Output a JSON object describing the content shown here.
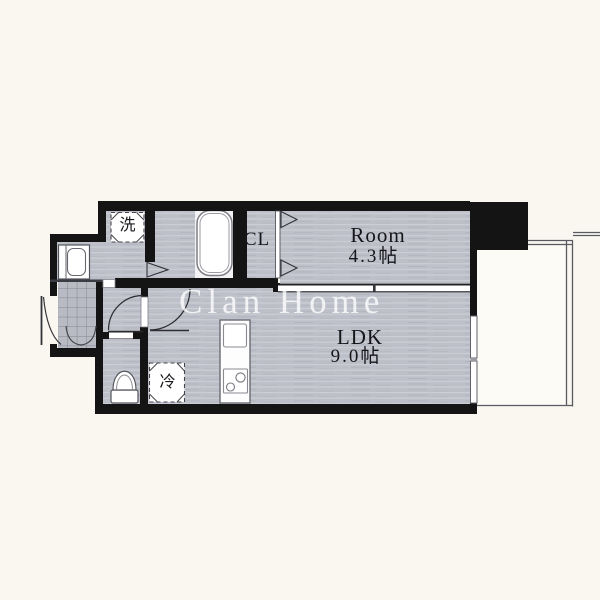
{
  "watermark": {
    "text": "Clan Home"
  },
  "rooms": {
    "bedroom": {
      "name": "Room",
      "size": "4.3帖"
    },
    "ldk": {
      "name": "LDK",
      "size": "9.0帖"
    },
    "closet": {
      "label": "CL"
    },
    "washing_machine": {
      "label": "洗"
    },
    "refrigerator": {
      "label": "冷"
    }
  },
  "colors": {
    "background": "#f9f7ef",
    "floor_gray": "#bec0c9",
    "wall_black": "#141414",
    "fixture_white": "#ffffff",
    "watermark_white": "rgba(255,255,255,0.78)"
  }
}
